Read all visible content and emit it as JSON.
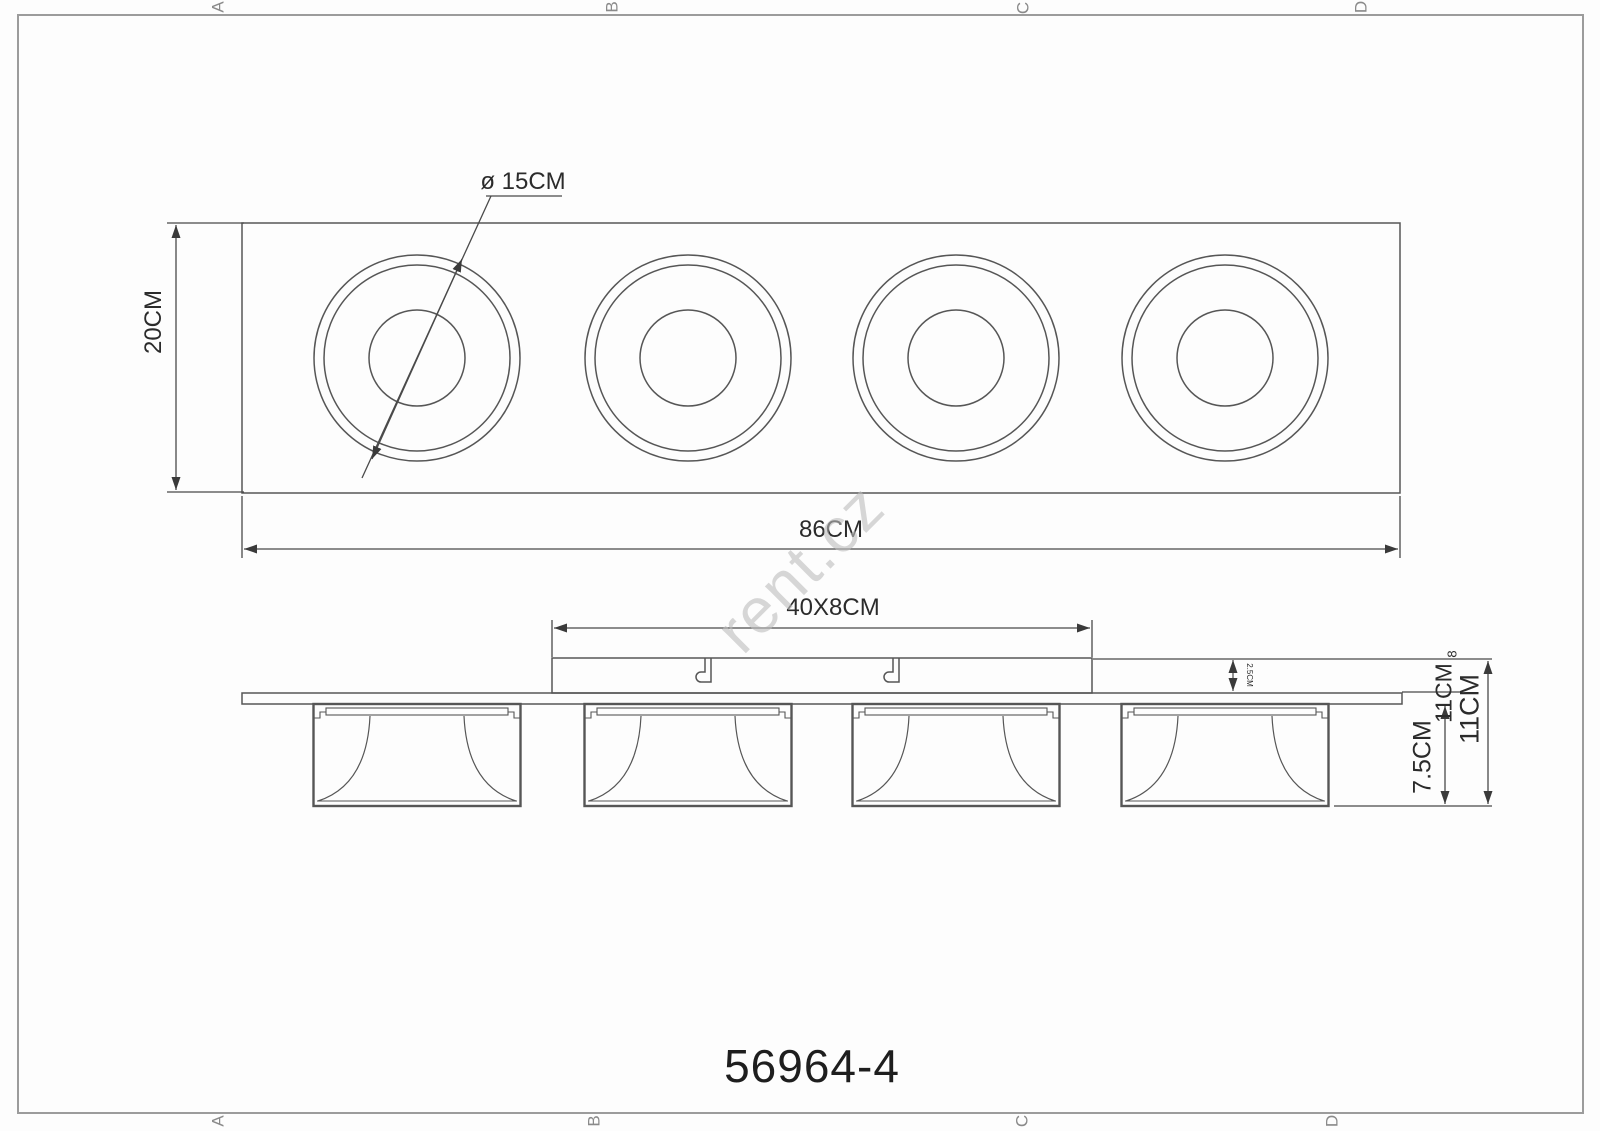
{
  "drawing": {
    "title_model": "56964-4",
    "watermark": "rent.cz",
    "labels": {
      "spot_diameter": "ø 15CM",
      "body_height": "20CM",
      "body_width": "86CM",
      "bracket_size": "40X8CM",
      "bracket_thickness": "2.5CM",
      "total_height": "11CM",
      "total_height_dup": "11CM",
      "head_depth": "7.5CM",
      "stray_eight": "8"
    },
    "border_markers": {
      "top": [
        "A",
        "B",
        "C",
        "D"
      ],
      "bottom": [
        "A",
        "B",
        "C",
        "D"
      ]
    },
    "colors": {
      "line": "#565656",
      "dimension_line": "#4a4a4a",
      "frame": "#9c9c9c",
      "text": "#2b2b2b",
      "watermark": "#bdbdbd",
      "background": "#fdfdfd"
    }
  }
}
